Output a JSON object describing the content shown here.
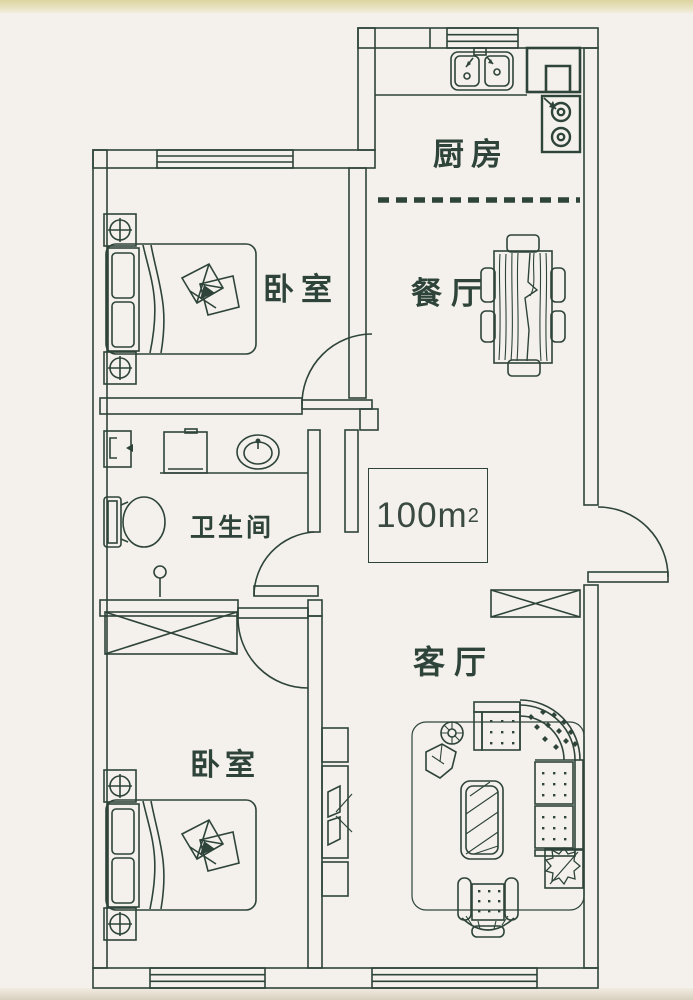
{
  "plan": {
    "title": "apartment-floor-plan",
    "area": {
      "value": "100m",
      "sup": "2"
    },
    "rooms": [
      {
        "id": "kitchen",
        "label": "厨房"
      },
      {
        "id": "dining-room",
        "label": "餐厅"
      },
      {
        "id": "bedroom-top",
        "label": "卧室"
      },
      {
        "id": "bathroom",
        "label": "卫生间"
      },
      {
        "id": "living-room",
        "label": "客厅"
      },
      {
        "id": "bedroom-bottom",
        "label": "卧室"
      }
    ],
    "colors": {
      "line": "#2e443a",
      "paper": "#f4f1ec",
      "paper_edge_top": "#dcd49f",
      "paper_edge_bottom": "#d8d0bf"
    }
  }
}
